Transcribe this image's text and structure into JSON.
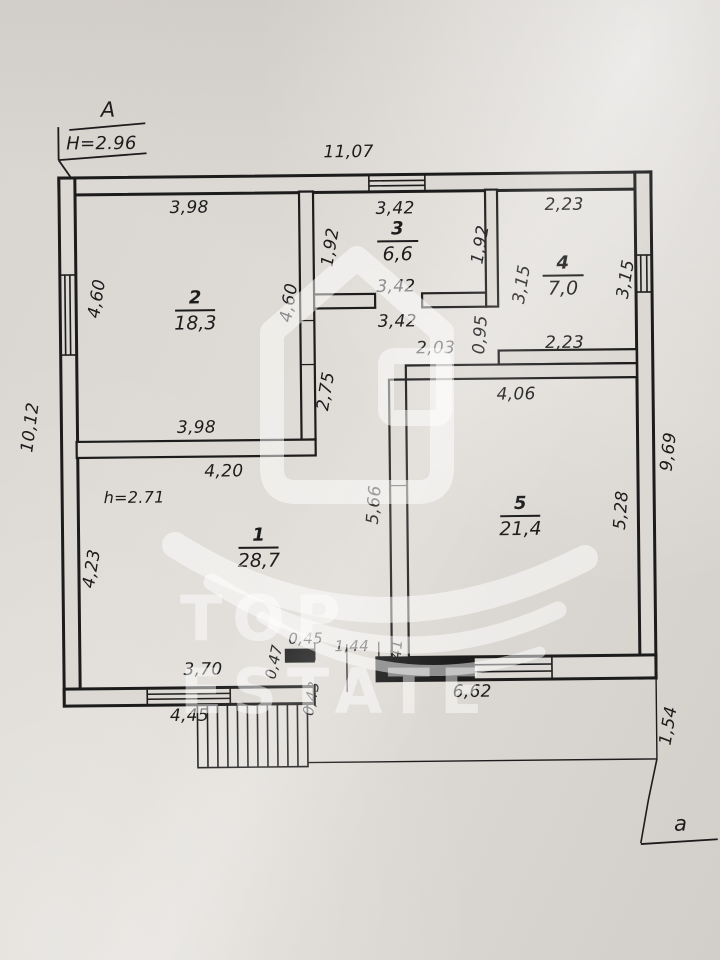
{
  "document_type": "floor-plan",
  "axis_marks": {
    "section_top": "А",
    "section_top_height": "H=2.96",
    "section_bottom": "а"
  },
  "notes": {
    "ceiling_height": "h=2.71"
  },
  "rooms": [
    {
      "number": "1",
      "area": "28,7"
    },
    {
      "number": "2",
      "area": "18,3"
    },
    {
      "number": "3",
      "area": "6,6"
    },
    {
      "number": "4",
      "area": "7,0"
    },
    {
      "number": "5",
      "area": "21,4"
    }
  ],
  "dims": [
    "11,07",
    "3,98",
    "3,42",
    "2,23",
    "1,92",
    "1,92",
    "3,15",
    "3,15",
    "4,60",
    "4,60",
    "3,42",
    "3,42",
    "2,03",
    "0,95",
    "2,23",
    "2,75",
    "3,98",
    "4,06",
    "4,20",
    "h=2.71",
    "10,12",
    "4,23",
    "5,66",
    "5,28",
    "9,69",
    "3,70",
    "0,45",
    "0,47",
    "1,44",
    "0,41",
    "0,43",
    "6,62",
    "4,45",
    "1,54"
  ],
  "watermark": {
    "brand": "TOP ESTATE",
    "logo": "house-logo"
  },
  "colors": {
    "paper": "#dcd8d3",
    "ink": "#1c1c1c",
    "watermark": "rgba(255,255,255,0.48)"
  }
}
